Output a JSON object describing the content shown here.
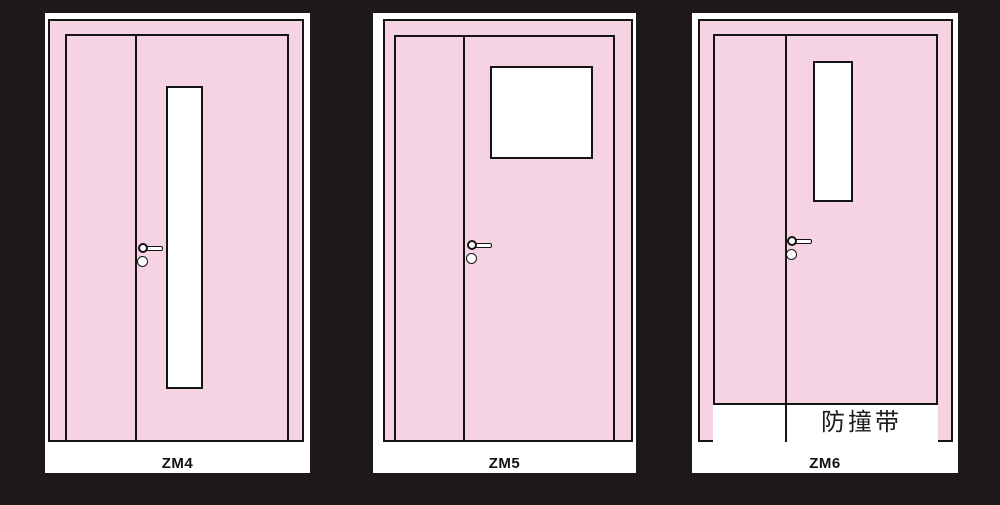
{
  "figure": {
    "kind": "door-elevation-drawings",
    "door_count": 3
  },
  "colors": {
    "background": "#1d1a19",
    "door_pink": "#f6d3e3",
    "outline": "#141414",
    "card_white": "#ffffff"
  },
  "doors": [
    {
      "label": "ZM4",
      "vision_panel": "tall-narrow"
    },
    {
      "label": "ZM5",
      "vision_panel": "square"
    },
    {
      "label": "ZM6",
      "vision_panel": "short-narrow",
      "bump_strip_label": "防撞带"
    }
  ]
}
